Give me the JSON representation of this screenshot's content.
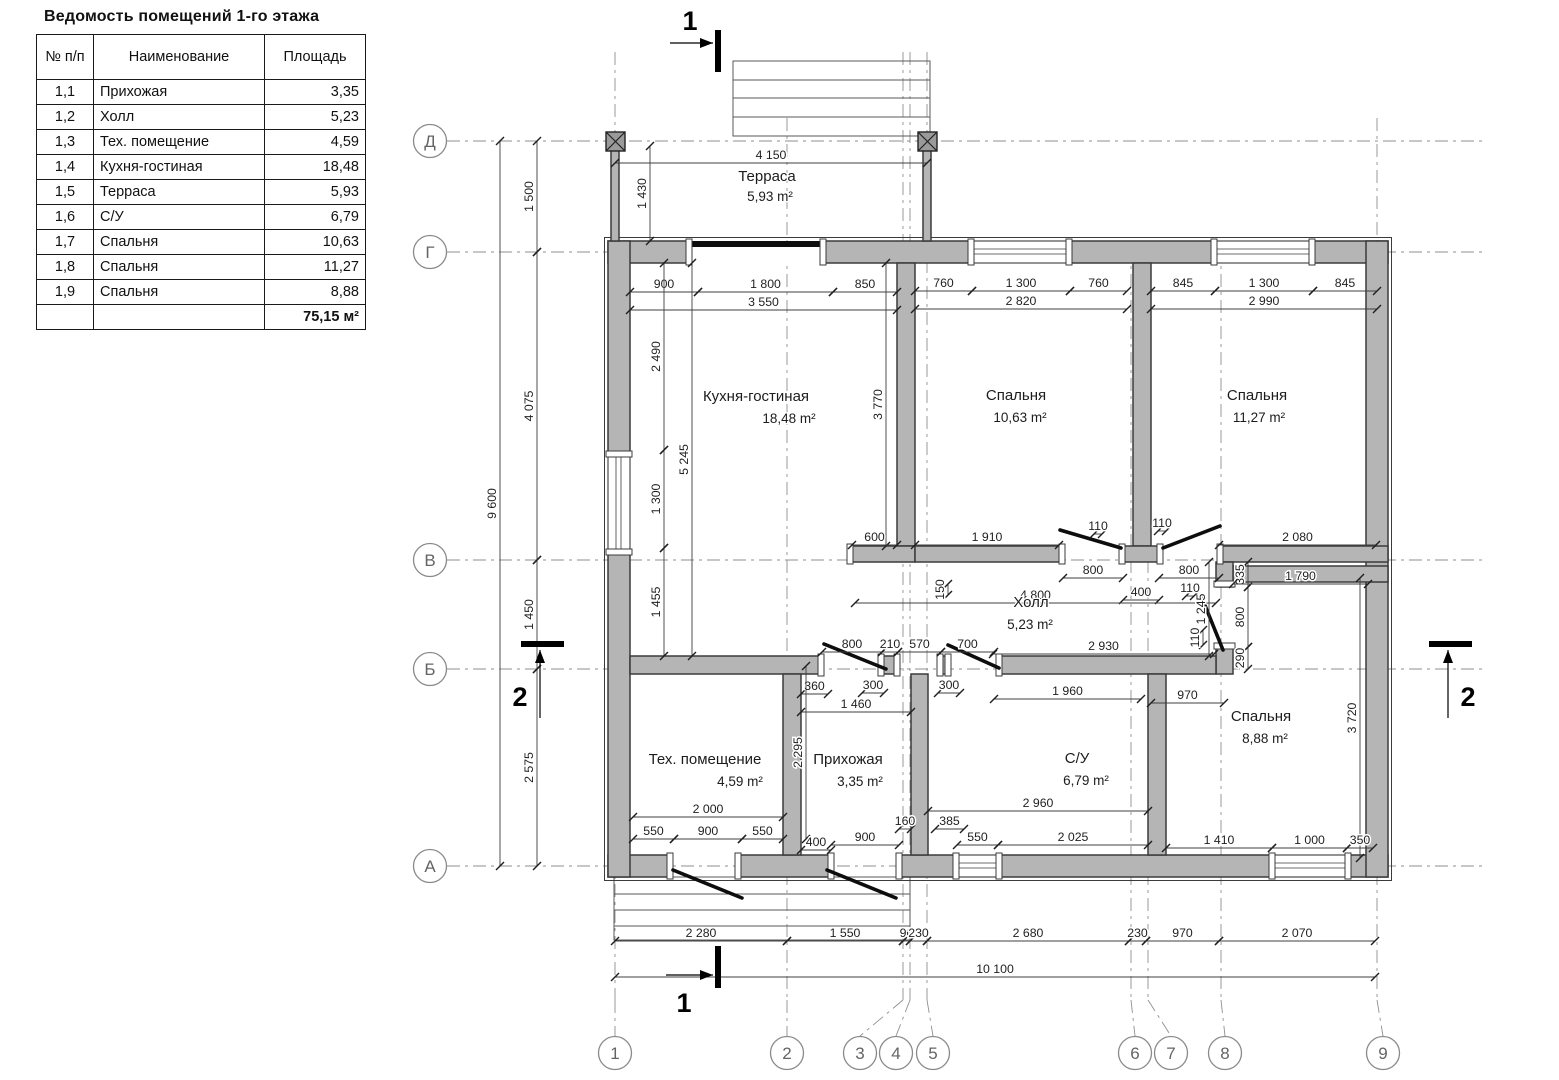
{
  "title": "Ведомость помещений 1-го этажа",
  "table": {
    "headers": {
      "num": "№ п/п",
      "name": "Наименование",
      "area": "Площадь"
    },
    "rows": [
      {
        "num": "1,1",
        "name": "Прихожая",
        "area": "3,35"
      },
      {
        "num": "1,2",
        "name": "Холл",
        "area": "5,23"
      },
      {
        "num": "1,3",
        "name": "Тех. помещение",
        "area": "4,59"
      },
      {
        "num": "1,4",
        "name": "Кухня-гостиная",
        "area": "18,48"
      },
      {
        "num": "1,5",
        "name": "Терраса",
        "area": "5,93"
      },
      {
        "num": "1,6",
        "name": "С/У",
        "area": "6,79"
      },
      {
        "num": "1,7",
        "name": "Спальня",
        "area": "10,63"
      },
      {
        "num": "1,8",
        "name": "Спальня",
        "area": "11,27"
      },
      {
        "num": "1,9",
        "name": "Спальня",
        "area": "8,88"
      }
    ],
    "total": "75,15 м²"
  },
  "plan": {
    "rooms": [
      {
        "id": "terrace",
        "name": "Терраса",
        "area": "5,93 m²",
        "nx": 767,
        "ny": 181,
        "ax": 770,
        "ay": 201
      },
      {
        "id": "kitchen-living",
        "name": "Кухня-гостиная",
        "area": "18,48 m²",
        "nx": 756,
        "ny": 401,
        "ax": 789,
        "ay": 423
      },
      {
        "id": "bedroom-1",
        "name": "Спальня",
        "area": "10,63 m²",
        "nx": 1016,
        "ny": 400,
        "ax": 1020,
        "ay": 422
      },
      {
        "id": "bedroom-2",
        "name": "Спальня",
        "area": "11,27 m²",
        "nx": 1257,
        "ny": 400,
        "ax": 1259,
        "ay": 422
      },
      {
        "id": "hall",
        "name": "Холл",
        "area": "5,23 m²",
        "nx": 1031,
        "ny": 607,
        "ax": 1030,
        "ay": 629
      },
      {
        "id": "tech-room",
        "name": "Тех. помещение",
        "area": "4,59 m²",
        "nx": 705,
        "ny": 764,
        "ax": 740,
        "ay": 786
      },
      {
        "id": "entry",
        "name": "Прихожая",
        "area": "3,35 m²",
        "nx": 848,
        "ny": 764,
        "ax": 860,
        "ay": 786
      },
      {
        "id": "wc",
        "name": "С/У",
        "area": "6,79 m²",
        "nx": 1077,
        "ny": 763,
        "ax": 1086,
        "ay": 785
      },
      {
        "id": "bedroom-3",
        "name": "Спальня",
        "area": "8,88 m²",
        "nx": 1261,
        "ny": 721,
        "ax": 1265,
        "ay": 743
      }
    ],
    "dims": [
      [
        "9 600",
        500,
        141,
        500,
        866
      ],
      [
        "1 500",
        537,
        141,
        537,
        252
      ],
      [
        "4 075",
        537,
        252,
        537,
        560
      ],
      [
        "1 450",
        537,
        560,
        537,
        669
      ],
      [
        "2 575",
        537,
        669,
        537,
        866
      ],
      [
        "4 150",
        615,
        163,
        927,
        163
      ],
      [
        "1 430",
        650,
        146,
        650,
        241
      ],
      [
        "900",
        630,
        292,
        698,
        292
      ],
      [
        "1 800",
        698,
        292,
        833,
        292
      ],
      [
        "850",
        833,
        292,
        897,
        292
      ],
      [
        "3 550",
        630,
        310,
        897,
        310
      ],
      [
        "2 490",
        664,
        263,
        664,
        450
      ],
      [
        "1 300",
        664,
        450,
        664,
        548
      ],
      [
        "1 455",
        664,
        548,
        664,
        656
      ],
      [
        "5 245",
        692,
        263,
        692,
        656
      ],
      [
        "3 770",
        886,
        263,
        886,
        546
      ],
      [
        "600",
        852,
        545,
        897,
        545
      ],
      [
        "760",
        915,
        291,
        972,
        291
      ],
      [
        "1 300",
        972,
        291,
        1070,
        291
      ],
      [
        "760",
        1070,
        291,
        1127,
        291
      ],
      [
        "2 820",
        915,
        309,
        1127,
        309
      ],
      [
        "845",
        1151,
        291,
        1215,
        291
      ],
      [
        "1 300",
        1215,
        291,
        1313,
        291
      ],
      [
        "845",
        1313,
        291,
        1377,
        291
      ],
      [
        "2 990",
        1151,
        309,
        1377,
        309
      ],
      [
        "1 910",
        915,
        545,
        1059,
        545
      ],
      [
        "110",
        1094,
        534,
        1102,
        534
      ],
      [
        "110",
        1158,
        531,
        1166,
        531
      ],
      [
        "2 080",
        1219,
        545,
        1376,
        545
      ],
      [
        "800",
        1063,
        578,
        1123,
        578
      ],
      [
        "800",
        1159,
        578,
        1219,
        578
      ],
      [
        "400",
        1123,
        600,
        1159,
        600
      ],
      [
        "4 800",
        855,
        603,
        1216,
        603
      ],
      [
        "150",
        948,
        584,
        948,
        595
      ],
      [
        "1 245",
        1209,
        562,
        1209,
        656
      ],
      [
        "335",
        1248,
        562,
        1248,
        587
      ],
      [
        "800",
        1248,
        587,
        1248,
        647
      ],
      [
        "290",
        1248,
        647,
        1248,
        669
      ],
      [
        "1 790",
        1233,
        584,
        1368,
        584
      ],
      [
        "110",
        1186,
        596,
        1194,
        596
      ],
      [
        "110",
        1203,
        630,
        1203,
        645
      ],
      [
        "2 930",
        993,
        654,
        1214,
        654
      ],
      [
        "800",
        822,
        652,
        882,
        652
      ],
      [
        "210",
        882,
        652,
        898,
        652
      ],
      [
        "570",
        898,
        652,
        941,
        652
      ],
      [
        "700",
        941,
        652,
        994,
        652
      ],
      [
        "300",
        862,
        693,
        884,
        693
      ],
      [
        "300",
        938,
        693,
        960,
        693
      ],
      [
        "360",
        801,
        694,
        828,
        694
      ],
      [
        "1 460",
        801,
        712,
        911,
        712
      ],
      [
        "2 295",
        806,
        666,
        806,
        839
      ],
      [
        "1 960",
        994,
        699,
        1141,
        699
      ],
      [
        "970",
        1151,
        703,
        1224,
        703
      ],
      [
        "3 720",
        1360,
        578,
        1360,
        858
      ],
      [
        "2 000",
        633,
        817,
        783,
        817
      ],
      [
        "550",
        633,
        839,
        674,
        839
      ],
      [
        "900",
        674,
        839,
        742,
        839
      ],
      [
        "550",
        742,
        839,
        783,
        839
      ],
      [
        "400",
        801,
        850,
        831,
        850
      ],
      [
        "900",
        831,
        845,
        899,
        845
      ],
      [
        "160",
        899,
        829,
        911,
        829
      ],
      [
        "385",
        935,
        829,
        964,
        829
      ],
      [
        "550",
        957,
        845,
        998,
        845
      ],
      [
        "2 960",
        928,
        811,
        1148,
        811
      ],
      [
        "2 025",
        998,
        845,
        1148,
        845
      ],
      [
        "1 410",
        1166,
        848,
        1272,
        848
      ],
      [
        "1 000",
        1272,
        848,
        1347,
        848
      ],
      [
        "350",
        1347,
        848,
        1373,
        848
      ],
      [
        "2 280",
        615,
        941,
        787,
        941
      ],
      [
        "1 550",
        787,
        941,
        903,
        941
      ],
      [
        "90",
        903,
        941,
        910,
        941
      ],
      [
        "230",
        910,
        941,
        927,
        941
      ],
      [
        "2 680",
        927,
        941,
        1129,
        941
      ],
      [
        "230",
        1129,
        941,
        1146,
        941
      ],
      [
        "970",
        1146,
        941,
        1219,
        941
      ],
      [
        "2 070",
        1219,
        941,
        1375,
        941
      ],
      [
        "10 100",
        615,
        977,
        1375,
        977
      ]
    ],
    "row_axes": [
      {
        "label": "Д",
        "y": 141
      },
      {
        "label": "Г",
        "y": 252
      },
      {
        "label": "В",
        "y": 560
      },
      {
        "label": "Б",
        "y": 669
      },
      {
        "label": "А",
        "y": 866
      }
    ],
    "col_axes": [
      {
        "label": "1",
        "bx": 615,
        "lx": 615,
        "top": 52
      },
      {
        "label": "2",
        "bx": 787,
        "lx": 787,
        "top": 118
      },
      {
        "label": "3",
        "bx": 860,
        "lx": 903,
        "top": 52
      },
      {
        "label": "4",
        "bx": 896,
        "lx": 910,
        "top": 52
      },
      {
        "label": "5",
        "bx": 933,
        "lx": 927,
        "top": 52
      },
      {
        "label": "6",
        "bx": 1135,
        "lx": 1131,
        "top": 248
      },
      {
        "label": "7",
        "bx": 1171,
        "lx": 1148,
        "top": 248
      },
      {
        "label": "8",
        "bx": 1225,
        "lx": 1221,
        "top": 248
      },
      {
        "label": "9",
        "bx": 1383,
        "lx": 1377,
        "top": 118
      }
    ],
    "section_marks": [
      {
        "label": "1",
        "bar": [
          715,
          30,
          6,
          42
        ],
        "line": [
          670,
          43,
          713,
          43
        ],
        "tip": "r",
        "num": [
          690,
          30
        ]
      },
      {
        "label": "1",
        "bar": [
          715,
          946,
          6,
          42
        ],
        "line": [
          666,
          975,
          713,
          975
        ],
        "tip": "r",
        "num": [
          684,
          1012
        ]
      },
      {
        "label": "2",
        "bar": [
          521,
          641,
          43,
          6
        ],
        "line": [
          540,
          718,
          540,
          650
        ],
        "tip": "u",
        "num": [
          520,
          706
        ]
      },
      {
        "label": "2",
        "bar": [
          1429,
          641,
          43,
          6
        ],
        "line": [
          1448,
          718,
          1448,
          650
        ],
        "tip": "u",
        "num": [
          1468,
          706
        ]
      }
    ]
  }
}
